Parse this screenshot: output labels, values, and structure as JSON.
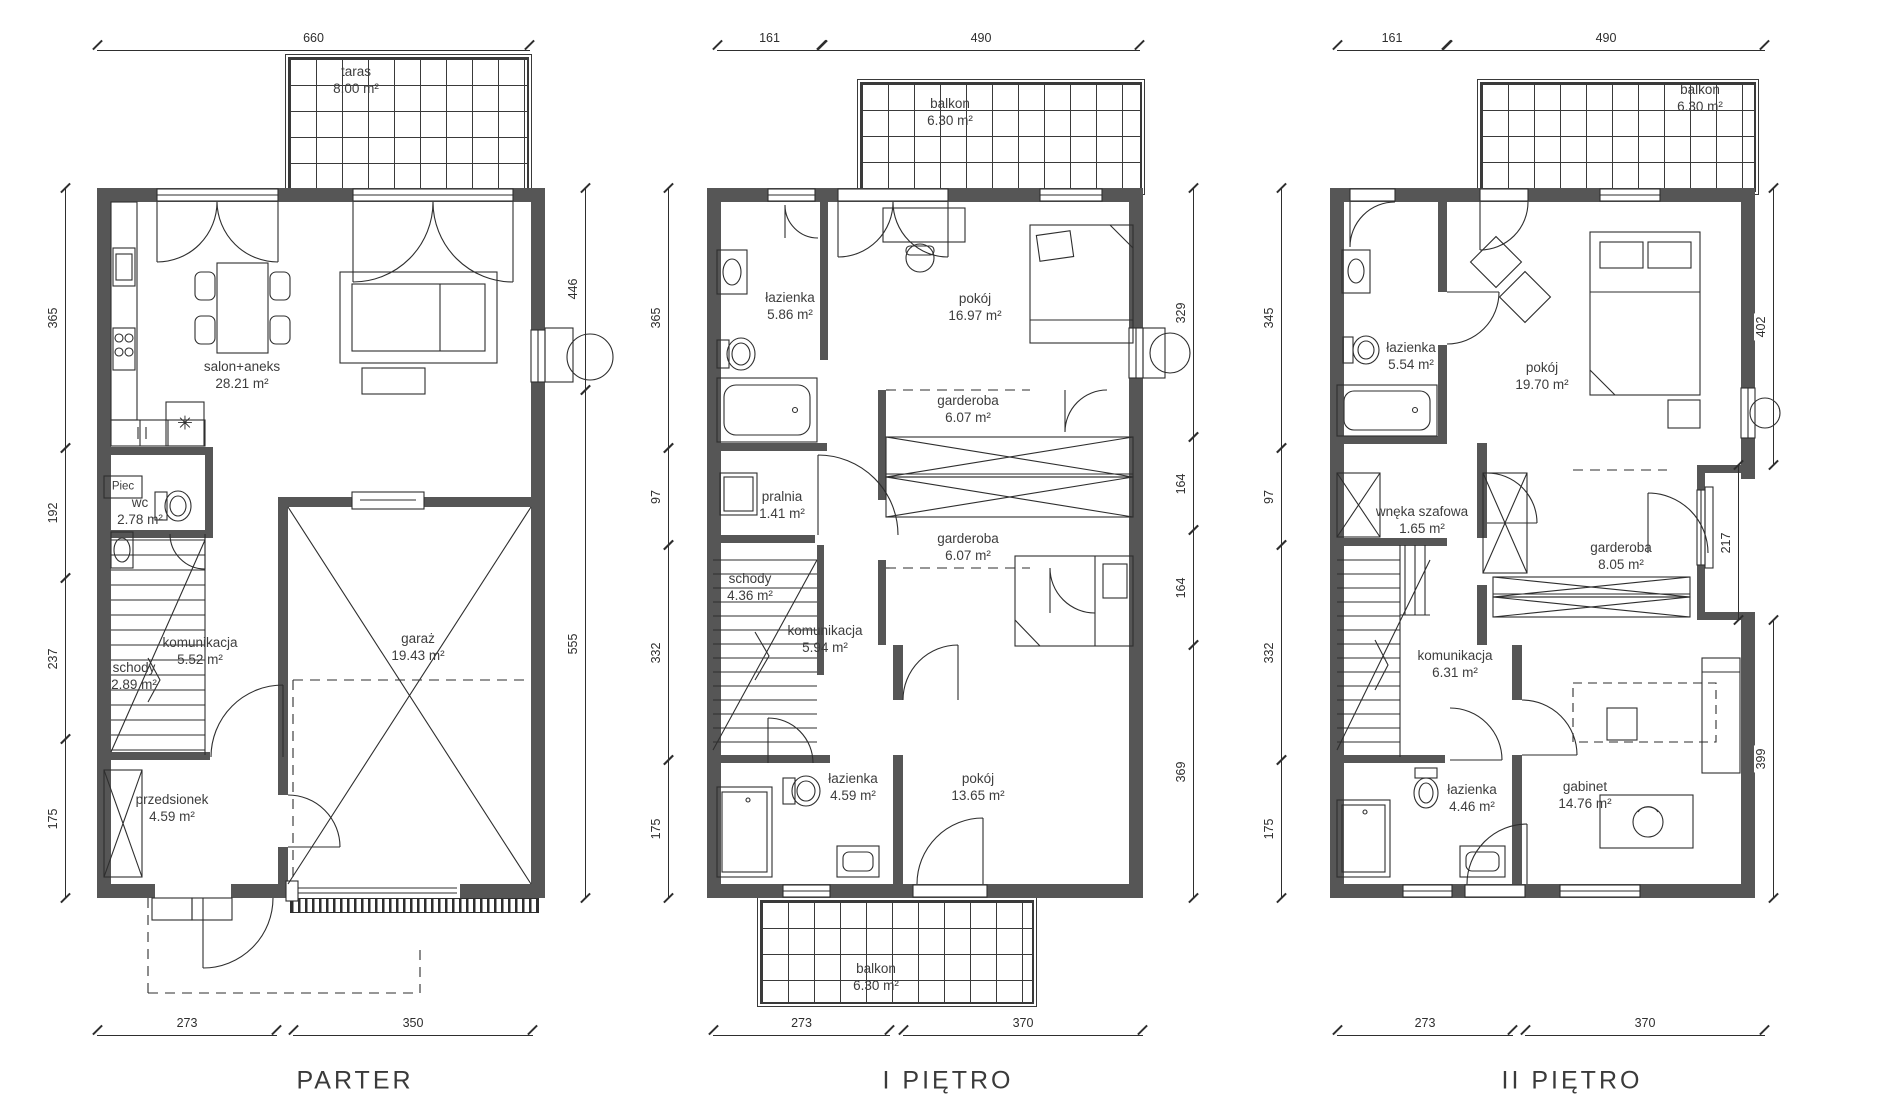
{
  "meta": {
    "background": "#ffffff",
    "wall_color": "#565656",
    "line_color": "#2e2e2e",
    "text_color": "#3a3a3a"
  },
  "icons": {
    "snowflake": "✳"
  },
  "floors": [
    {
      "title": "PARTER",
      "rooms": {
        "taras": {
          "name": "taras",
          "area": "8.00 m²"
        },
        "salon": {
          "name": "salon+aneks",
          "area": "28.21 m²"
        },
        "piec": {
          "name": "Piec",
          "area": ""
        },
        "wc": {
          "name": "wc",
          "area": "2.78 m²"
        },
        "komunikacja": {
          "name": "komunikacja",
          "area": "5.52 m²"
        },
        "schody": {
          "name": "schody",
          "area": "2.89 m²"
        },
        "przedsionek": {
          "name": "przedsionek",
          "area": "4.59 m²"
        },
        "garaz": {
          "name": "garaż",
          "area": "19.43 m²"
        }
      },
      "dims": {
        "top1": "660",
        "left1": "365",
        "left2": "192",
        "left3": "237",
        "left4": "175",
        "right1": "446",
        "right2": "555",
        "bottom1": "273",
        "bottom2": "350"
      }
    },
    {
      "title": "I PIĘTRO",
      "rooms": {
        "balkon_top": {
          "name": "balkon",
          "area": "6.30 m²"
        },
        "lazienka_top": {
          "name": "łazienka",
          "area": "5.86 m²"
        },
        "pokoj_top": {
          "name": "pokój",
          "area": "16.97 m²"
        },
        "garderoba1": {
          "name": "garderoba",
          "area": "6.07 m²"
        },
        "garderoba2": {
          "name": "garderoba",
          "area": "6.07 m²"
        },
        "pralnia": {
          "name": "pralnia",
          "area": "1.41 m²"
        },
        "schody": {
          "name": "schody",
          "area": "4.36 m²"
        },
        "komunikacja": {
          "name": "komunikacja",
          "area": "5.94 m²"
        },
        "lazienka_dol": {
          "name": "łazienka",
          "area": "4.59 m²"
        },
        "pokoj_dol": {
          "name": "pokój",
          "area": "13.65 m²"
        },
        "balkon_dol": {
          "name": "balkon",
          "area": "6.30 m²"
        }
      },
      "dims": {
        "top1": "161",
        "top2": "490",
        "left1": "365",
        "left2": "97",
        "left3": "332",
        "left4": "175",
        "right1": "329",
        "right2": "164",
        "right3": "164",
        "right4": "369",
        "bottom1": "273",
        "bottom2": "370"
      }
    },
    {
      "title": "II PIĘTRO",
      "rooms": {
        "balkon_top": {
          "name": "balkon",
          "area": "6.30 m²"
        },
        "lazienka_top": {
          "name": "łazienka",
          "area": "5.54 m²"
        },
        "pokoj": {
          "name": "pokój",
          "area": "19.70 m²"
        },
        "wneka": {
          "name": "wnęka szafowa",
          "area": "1.65 m²"
        },
        "garderoba": {
          "name": "garderoba",
          "area": "8.05 m²"
        },
        "komunikacja": {
          "name": "komunikacja",
          "area": "6.31 m²"
        },
        "lazienka_dol": {
          "name": "łazienka",
          "area": "4.46 m²"
        },
        "gabinet": {
          "name": "gabinet",
          "area": "14.76 m²"
        }
      },
      "dims": {
        "top1": "161",
        "top2": "490",
        "left1": "345",
        "left2": "97",
        "left3": "332",
        "left4": "175",
        "right1": "402",
        "right2": "217",
        "right3": "399",
        "bottom1": "273",
        "bottom2": "370"
      }
    }
  ]
}
